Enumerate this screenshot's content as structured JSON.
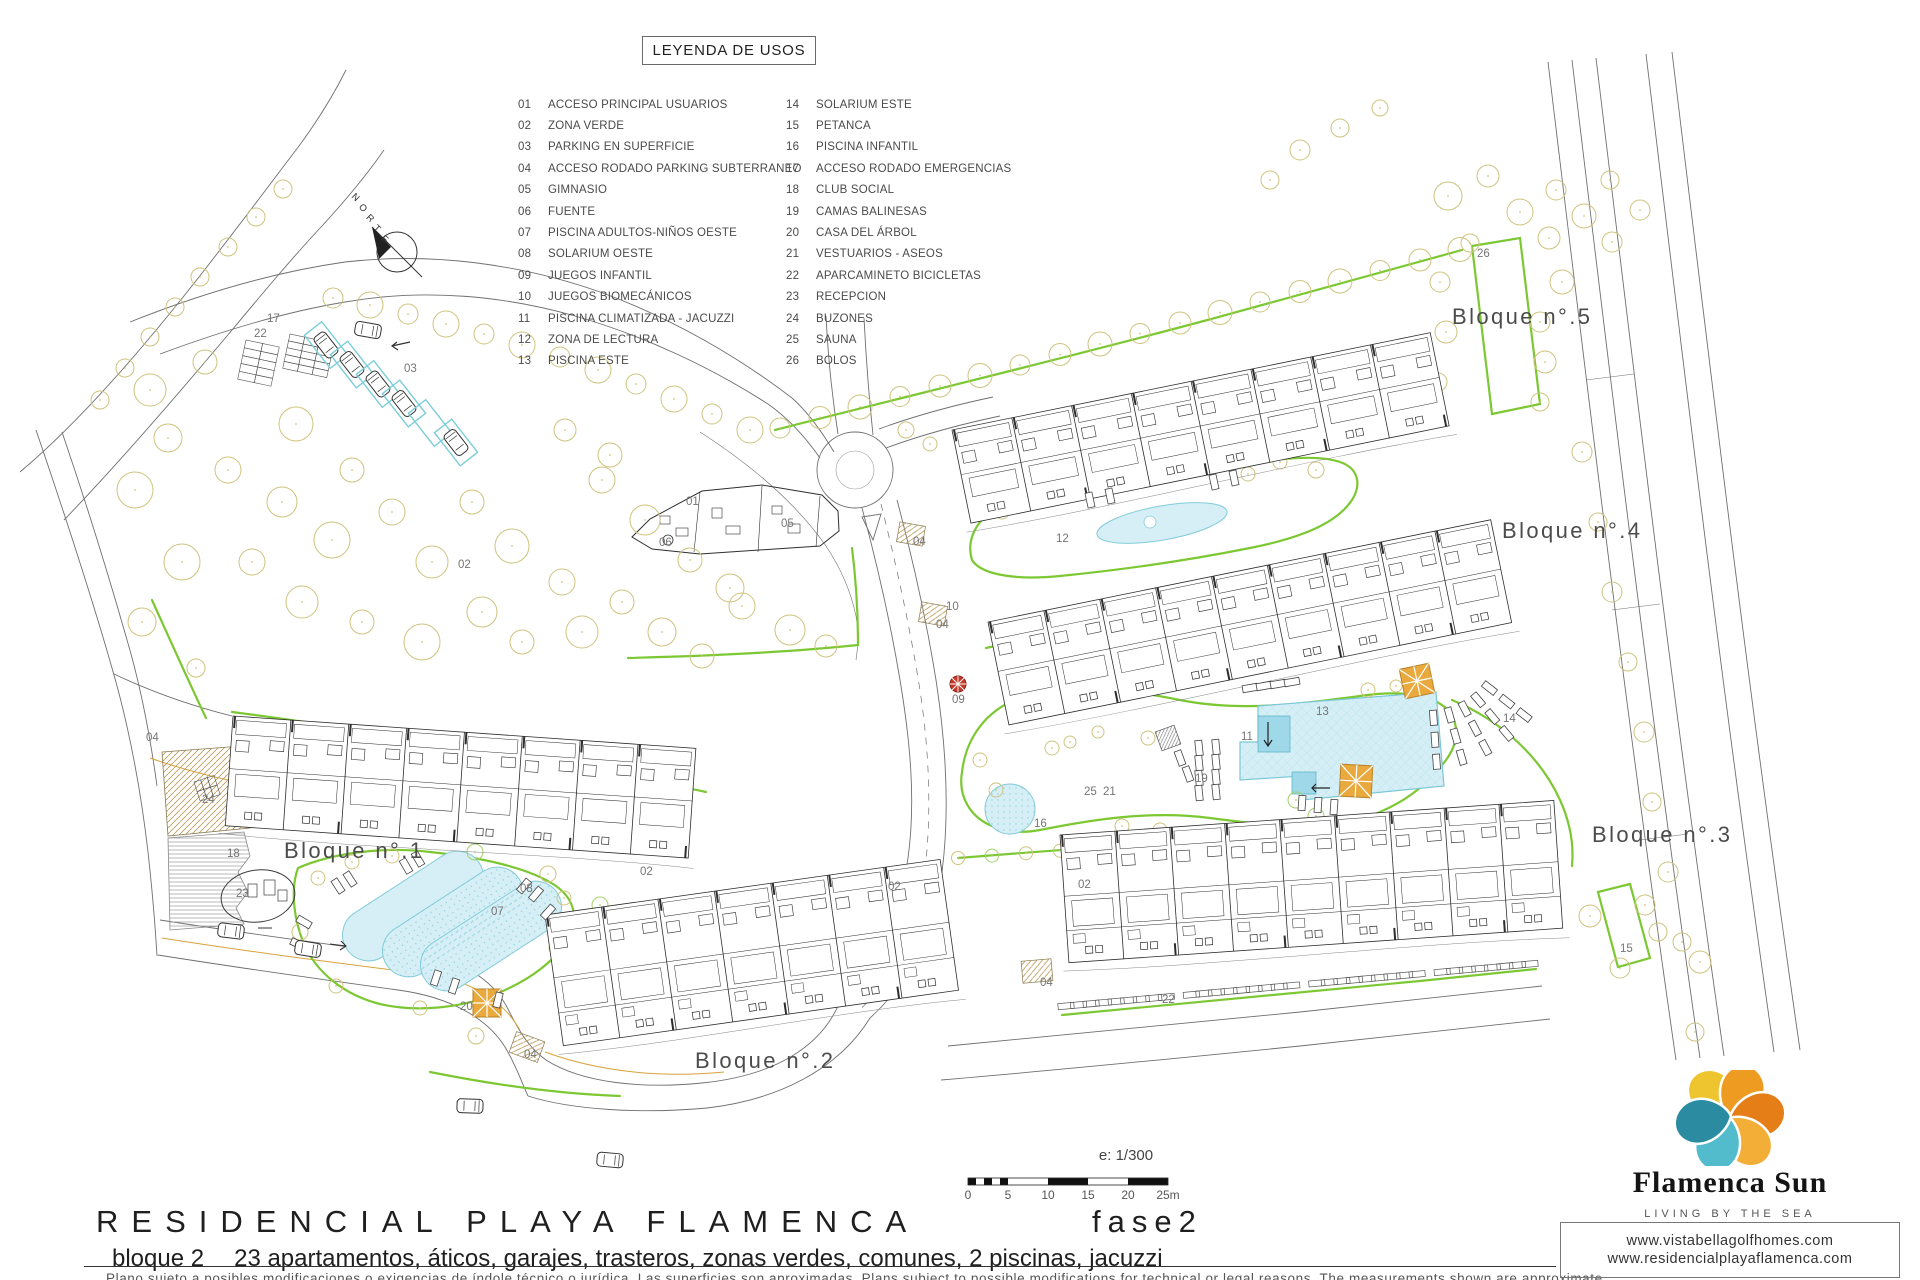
{
  "legend": {
    "title": "LEYENDA DE USOS",
    "items": [
      {
        "num": "01",
        "label": "ACCESO PRINCIPAL USUARIOS"
      },
      {
        "num": "02",
        "label": "ZONA VERDE"
      },
      {
        "num": "03",
        "label": "PARKING EN SUPERFICIE"
      },
      {
        "num": "04",
        "label": "ACCESO RODADO PARKING SUBTERRANEO"
      },
      {
        "num": "05",
        "label": "GIMNASIO"
      },
      {
        "num": "06",
        "label": "FUENTE"
      },
      {
        "num": "07",
        "label": "PISCINA ADULTOS-NIÑOS OESTE"
      },
      {
        "num": "08",
        "label": "SOLARIUM OESTE"
      },
      {
        "num": "09",
        "label": "JUEGOS INFANTIL"
      },
      {
        "num": "10",
        "label": "JUEGOS BIOMECÁNICOS"
      },
      {
        "num": "11",
        "label": "PISCINA CLIMATIZADA - JACUZZI"
      },
      {
        "num": "12",
        "label": "ZONA DE LECTURA"
      },
      {
        "num": "13",
        "label": "PISCINA ESTE"
      },
      {
        "num": "14",
        "label": "SOLARIUM ESTE"
      },
      {
        "num": "15",
        "label": "PETANCA"
      },
      {
        "num": "16",
        "label": "PISCINA INFANTIL"
      },
      {
        "num": "17",
        "label": "ACCESO RODADO EMERGENCIAS"
      },
      {
        "num": "18",
        "label": "CLUB SOCIAL"
      },
      {
        "num": "19",
        "label": "CAMAS BALINESAS"
      },
      {
        "num": "20",
        "label": "CASA DEL ÁRBOL"
      },
      {
        "num": "21",
        "label": "VESTUARIOS - ASEOS"
      },
      {
        "num": "22",
        "label": "APARCAMINETO BICICLETAS"
      },
      {
        "num": "23",
        "label": "RECEPCION"
      },
      {
        "num": "24",
        "label": "BUZONES"
      },
      {
        "num": "25",
        "label": "SAUNA"
      },
      {
        "num": "26",
        "label": "BOLOS"
      }
    ]
  },
  "plan": {
    "compass_label": "NORTE",
    "block_labels": [
      {
        "label": "Bloque n°.1",
        "x": 284,
        "y": 858
      },
      {
        "label": "Bloque n°.2",
        "x": 695,
        "y": 1068
      },
      {
        "label": "Bloque n°.3",
        "x": 1592,
        "y": 842
      },
      {
        "label": "Bloque n°.4",
        "x": 1502,
        "y": 538
      },
      {
        "label": "Bloque n°.5",
        "x": 1452,
        "y": 324
      }
    ],
    "area_labels": [
      {
        "num": "17",
        "x": 267,
        "y": 322
      },
      {
        "num": "22",
        "x": 254,
        "y": 337
      },
      {
        "num": "03",
        "x": 404,
        "y": 372
      },
      {
        "num": "01",
        "x": 686,
        "y": 505
      },
      {
        "num": "05",
        "x": 781,
        "y": 527
      },
      {
        "num": "06",
        "x": 659,
        "y": 546
      },
      {
        "num": "02",
        "x": 458,
        "y": 568
      },
      {
        "num": "02",
        "x": 640,
        "y": 875
      },
      {
        "num": "02",
        "x": 888,
        "y": 890
      },
      {
        "num": "02",
        "x": 1078,
        "y": 888
      },
      {
        "num": "04",
        "x": 146,
        "y": 741
      },
      {
        "num": "04",
        "x": 913,
        "y": 545
      },
      {
        "num": "04",
        "x": 936,
        "y": 628
      },
      {
        "num": "04",
        "x": 524,
        "y": 1058
      },
      {
        "num": "04",
        "x": 1040,
        "y": 986
      },
      {
        "num": "24",
        "x": 202,
        "y": 803
      },
      {
        "num": "18",
        "x": 227,
        "y": 857
      },
      {
        "num": "23",
        "x": 236,
        "y": 897
      },
      {
        "num": "20",
        "x": 460,
        "y": 1010
      },
      {
        "num": "08",
        "x": 520,
        "y": 892
      },
      {
        "num": "07",
        "x": 491,
        "y": 915
      },
      {
        "num": "09",
        "x": 952,
        "y": 703
      },
      {
        "num": "10",
        "x": 946,
        "y": 610
      },
      {
        "num": "16",
        "x": 1034,
        "y": 827
      },
      {
        "num": "25",
        "x": 1084,
        "y": 795
      },
      {
        "num": "21",
        "x": 1103,
        "y": 795
      },
      {
        "num": "19",
        "x": 1195,
        "y": 782
      },
      {
        "num": "11",
        "x": 1241,
        "y": 740
      },
      {
        "num": "13",
        "x": 1316,
        "y": 715
      },
      {
        "num": "12",
        "x": 1056,
        "y": 542
      },
      {
        "num": "14",
        "x": 1503,
        "y": 722
      },
      {
        "num": "15",
        "x": 1620,
        "y": 952
      },
      {
        "num": "26",
        "x": 1477,
        "y": 257
      },
      {
        "num": "22",
        "x": 1162,
        "y": 1003
      }
    ]
  },
  "scale": {
    "ratio_label": "e: 1/300",
    "tick_labels": [
      "0",
      "5",
      "10",
      "15",
      "20",
      "25m"
    ]
  },
  "footer": {
    "project_title": "RESIDENCIAL PLAYA FLAMENCA",
    "phase_label": "fase2",
    "block_summary_prefix": "bloque 2",
    "block_summary": "23 apartamentos, áticos, garajes, trasteros, zonas verdes, comunes, 2 piscinas, jacuzzi",
    "disclaimer": "Plano sujeto a posibles modificaciones o exigencias de índole técnico o jurídica. Las superficies son aproximadas. Plans subject to possible modifications for technical or legal reasons. The measurements shown are approximate."
  },
  "brand": {
    "name": "Flamenca Sun",
    "tagline": "LIVING BY THE SEA",
    "websites": [
      "www.vistabellagolfhomes.com",
      "www.residencialplayaflamenca.com"
    ]
  },
  "colors": {
    "green_line": "#7cc832",
    "pool_fill": "#d6eff6",
    "pool_edge": "#83ccd9",
    "tree_olive": "#cfc37e",
    "tree_green": "#a5d06e",
    "deck_orange": "#e9a93d",
    "accent_red": "#c23b2a"
  }
}
